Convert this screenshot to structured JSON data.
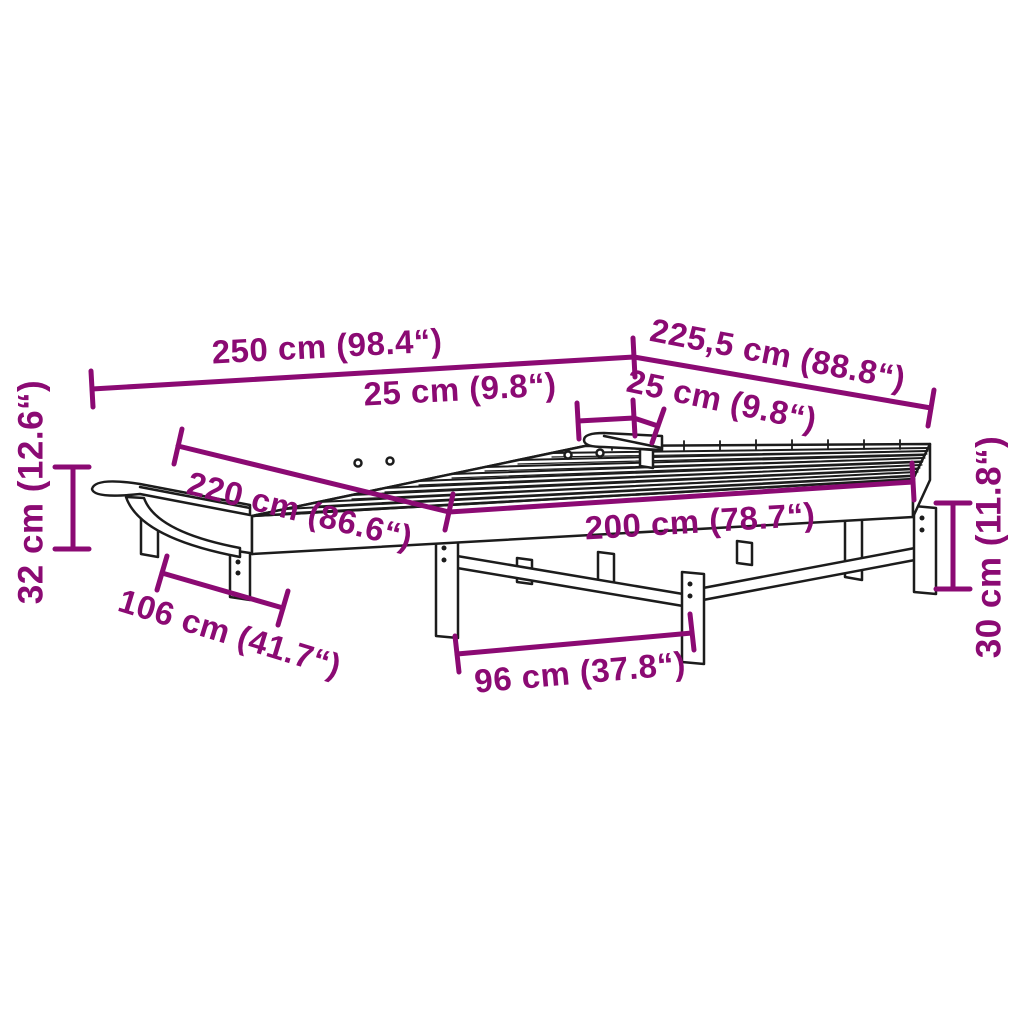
{
  "colors": {
    "dimension": "#8b0a73",
    "drawing": "#1c1c1c",
    "background": "#ffffff"
  },
  "subject": "bed-frame-with-slatted-base-and-two-trays-line-drawing",
  "dims": {
    "d250": {
      "label": "250 cm (98.4“)"
    },
    "d2255": {
      "label": "225,5 cm (88.8“)"
    },
    "d25a": {
      "label": "25 cm (9.8“)"
    },
    "d25b": {
      "label": "25 cm (9.8“)"
    },
    "d220": {
      "label": "220 cm (86.6“)"
    },
    "d200": {
      "label": "200 cm (78.7“)"
    },
    "d106": {
      "label": "106 cm (41.7“)"
    },
    "d96": {
      "label": "96 cm (37.8“)"
    },
    "d32": {
      "label": "32 cm (12.6“)"
    },
    "d30": {
      "label": "30 cm (11.8“)"
    }
  }
}
